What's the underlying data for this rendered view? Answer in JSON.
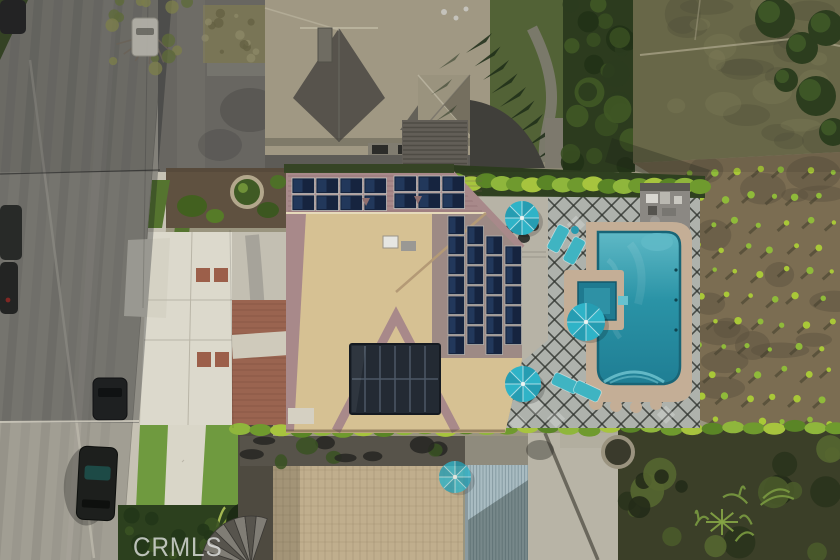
{
  "watermark": {
    "text": "CRMLS"
  },
  "scene": {
    "kind": "aerial-drone-photo",
    "subject": "Top-down aerial view of a residential lot: tile-roof house with rooftop solar arrays, backyard pool and spa with teal umbrellas and loungers on a diamond-lattice patio, street with parked cars at left, neighboring houses above and below, and a planted brown field to the right",
    "counts": {
      "umbrellas": 4,
      "lounge_chairs": 4,
      "ridge_solar_panels": 14,
      "slope_solar_panels": 26,
      "parked_cars": 4
    }
  },
  "colors": {
    "street": "#a19e93",
    "gutter": "#bcb8ab",
    "sidewalk": "#c6c2b4",
    "lawn": "#6f9a3f",
    "lawn_shaded": "#55742f",
    "hedge_dark": "#2f4020",
    "hedge_lit": "#8fb63c",
    "soil": "#5f5140",
    "driveway": "#dcd9cc",
    "brick": "#9c5f4a",
    "brick_court": "#9a6450",
    "roof_pink": "#a8898a",
    "roof_pink_shade": "#9d8a85",
    "roof_tan": "#d6c193",
    "neighbor_khaki": "#b0a890",
    "neighbor_shade": "#5f5b53",
    "bottom_roof_tan": "#c0ae8d",
    "courtyard": "#72706a",
    "solar": "#16243f",
    "solar_sheen": "#2e4c78",
    "patio_tile": "#aeb2ac",
    "lattice_line": "#2f332e",
    "patio_concrete": "#b7b3a6",
    "pool_light": "#5fb9c6",
    "pool_mid": "#2a93a6",
    "pool_deep": "#1f7e94",
    "spa": "#1f7a90",
    "coping": "#c4ae96",
    "umbrella": "#2fb3c7",
    "umbrella_dark": "#1f8ba0",
    "lounger": "#3fb4c2",
    "field_upper": "#72714e",
    "field": "#7b6d52",
    "plant": "#a9c838",
    "pergola": "#a9bcc2",
    "concrete": "#b8b4a6",
    "garden_dark": "#3b3f28",
    "window_dark": "#232a33",
    "equip_pad": "#8b8883",
    "shade": "rgba(18,20,26,0.30)"
  }
}
